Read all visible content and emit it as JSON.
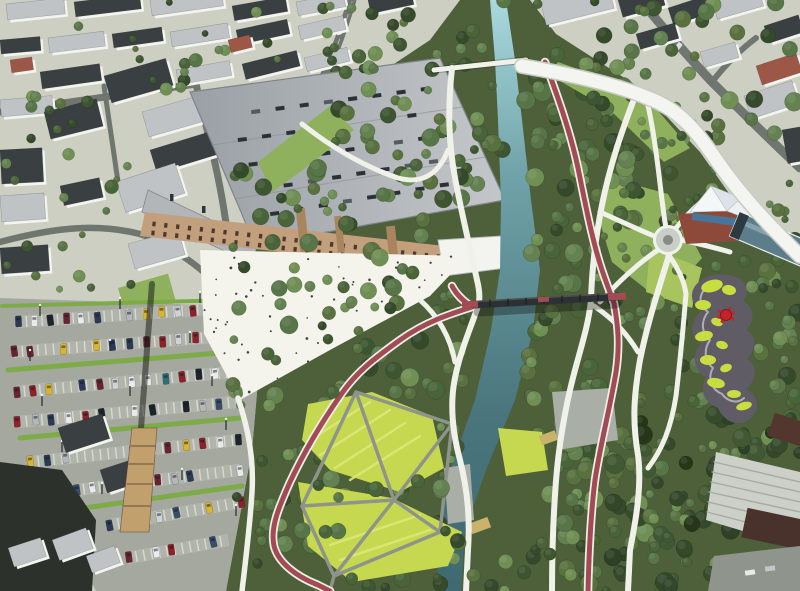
{
  "palette": {
    "forest_base": "#4d6039",
    "urban_base": "#cdcfc2",
    "street": "#6f756f",
    "street_dash": "#e8eae2",
    "asphalt": "#a4a89f",
    "bay": "#b9bdb3",
    "marking": "#dddfd6",
    "parking_green": "#7cab48",
    "lawn": "#8fb05c",
    "lawn_bright": "#a8c45e",
    "roof_dark": "#3a3f42",
    "roof_gray": "#c0c3c6",
    "roof_red": "#9c5747",
    "building_white": "#f3f4ef",
    "factory_a": "#9aa0a5",
    "factory_b": "#c4c7ca",
    "skylight": "#2b3136",
    "brick": "#c29f7d",
    "brick_dark": "#a8855f",
    "window_dark": "#4b3a2d",
    "plaza": "#f4f3ec",
    "people": "#3b4046",
    "river_top": "#a9d8de",
    "river_mid": "#6fa2a8",
    "river_low": "#4a757d",
    "river_bottom": "#3f6a72",
    "path_white": "#f0f2ea",
    "path_edge": "#b9c0b2",
    "path_gray": "#8e948a",
    "path_red": "#a34b54",
    "red_edge": "#eef0e8",
    "bridge_dark": "#2d3134",
    "meadow": "#c6d850",
    "meadow_light": "#dce878",
    "play_surface": "#5f5c66",
    "play_lime": "#c8dd3f",
    "play_red": "#c4232a",
    "terracotta": "#8d4a3a",
    "hall_roof": "#5d7d8b",
    "hall_glass": "#8aa8b4",
    "hall_dark": "#2d3a40",
    "pavilion_glass": "#49759b",
    "viaduct": "#f4f5f0",
    "viaduct_edge": "#c6ccc4",
    "terrace": "#ccd0c8",
    "terrace_line": "#a6aba1",
    "maroon_a": "#53362e",
    "maroon_b": "#4a322c",
    "courtyard": "#8f948c",
    "dark_mass": "#2c312c",
    "chimney": "#c2a06e",
    "deck_wood": "#c9b26a",
    "pocket": "#a9aea6",
    "tree_greens": [
      "#3e5531",
      "#4a6439",
      "#577547",
      "#648251",
      "#6f8f55",
      "#35492b",
      "#59713f"
    ],
    "tree_darks": [
      "#2e4026",
      "#364b2c",
      "#415835",
      "#263619",
      "#33472a"
    ],
    "car_colors": [
      "#2c3a55",
      "#8f212b",
      "#e8eaeb",
      "#b3b8bd",
      "#1f252d",
      "#d9b430",
      "#2f6e76",
      "#6b2330",
      "#3a4d6b",
      "#cfd3d6"
    ]
  }
}
